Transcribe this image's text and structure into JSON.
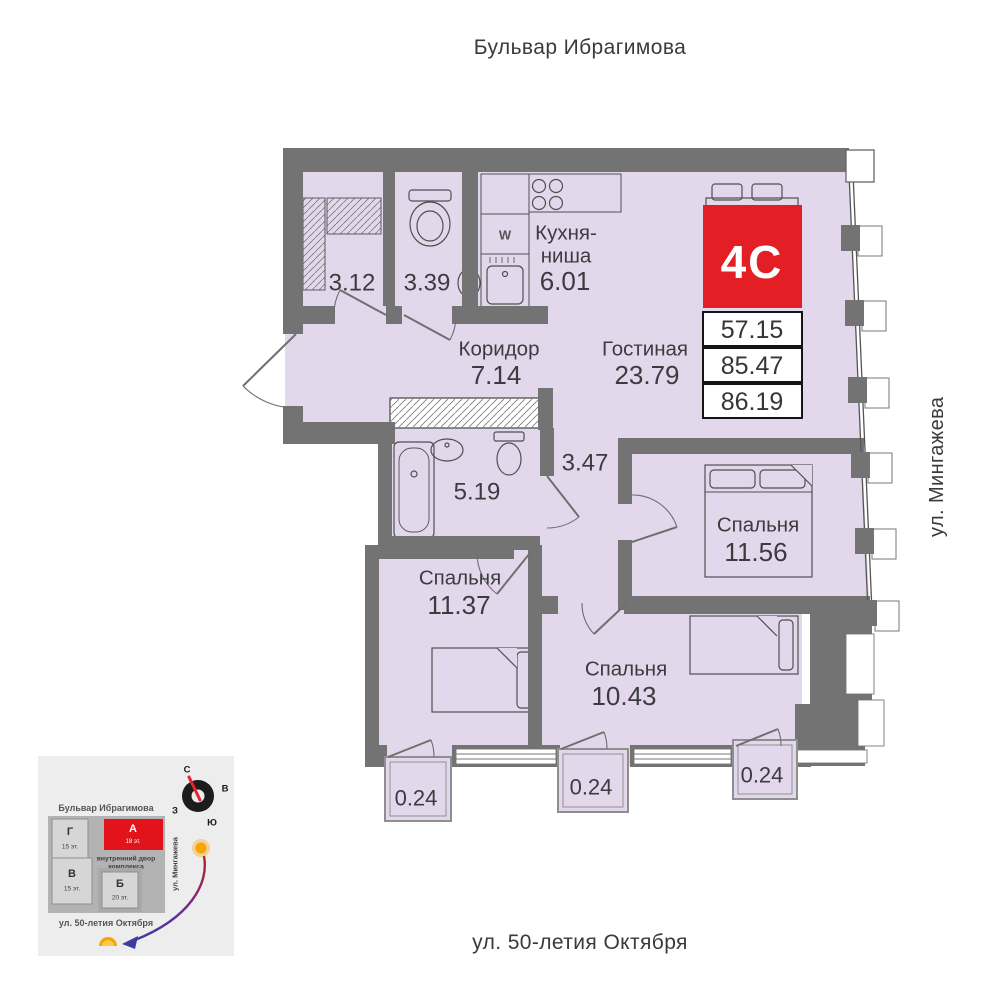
{
  "streets": {
    "top": "Бульвар Ибрагимова",
    "right": "ул. Мингажева",
    "bottom": "ул. 50-летия Октября"
  },
  "unit": {
    "type_label": "4С",
    "area_1": "57.15",
    "area_2": "85.47",
    "area_3": "86.19"
  },
  "rooms": {
    "closet": {
      "area": "3.12"
    },
    "wc": {
      "area": "3.39"
    },
    "kitchen": {
      "name1": "Кухня-",
      "name2": "ниша",
      "area": "6.01"
    },
    "corridor": {
      "name": "Коридор",
      "area": "7.14"
    },
    "living": {
      "name": "Гостиная",
      "area": "23.79"
    },
    "bathroom": {
      "area": "5.19"
    },
    "hall": {
      "area": "3.47"
    },
    "bedroom1": {
      "name": "Спальня",
      "area": "11.56"
    },
    "bedroom2": {
      "name": "Спальня",
      "area": "11.37"
    },
    "bedroom3": {
      "name": "Спальня",
      "area": "10.43"
    },
    "balcony1": {
      "area": "0.24"
    },
    "balcony2": {
      "area": "0.24"
    },
    "balcony3": {
      "area": "0.24"
    }
  },
  "fixtures": {
    "washer_label": "W"
  },
  "minimap": {
    "compass": {
      "north": "С",
      "east": "В",
      "west": "З",
      "south": "Ю"
    },
    "street_top": "Бульвар Ибрагимова",
    "street_right": "ул. Мингажева",
    "street_bottom": "ул. 50-летия Октября",
    "courtyard1": "внутренний двор",
    "courtyard2": "комплекса",
    "buildings": {
      "g": {
        "label": "Г",
        "floors": "15 эт."
      },
      "v": {
        "label": "В",
        "floors": "15 эт."
      },
      "a": {
        "label": "А",
        "floors": "18 эт."
      },
      "b": {
        "label": "Б",
        "floors": "20 эт."
      }
    }
  },
  "colors": {
    "accent_red": "#e31e24",
    "floor": "#e3d8eb",
    "wall": "#737373"
  }
}
